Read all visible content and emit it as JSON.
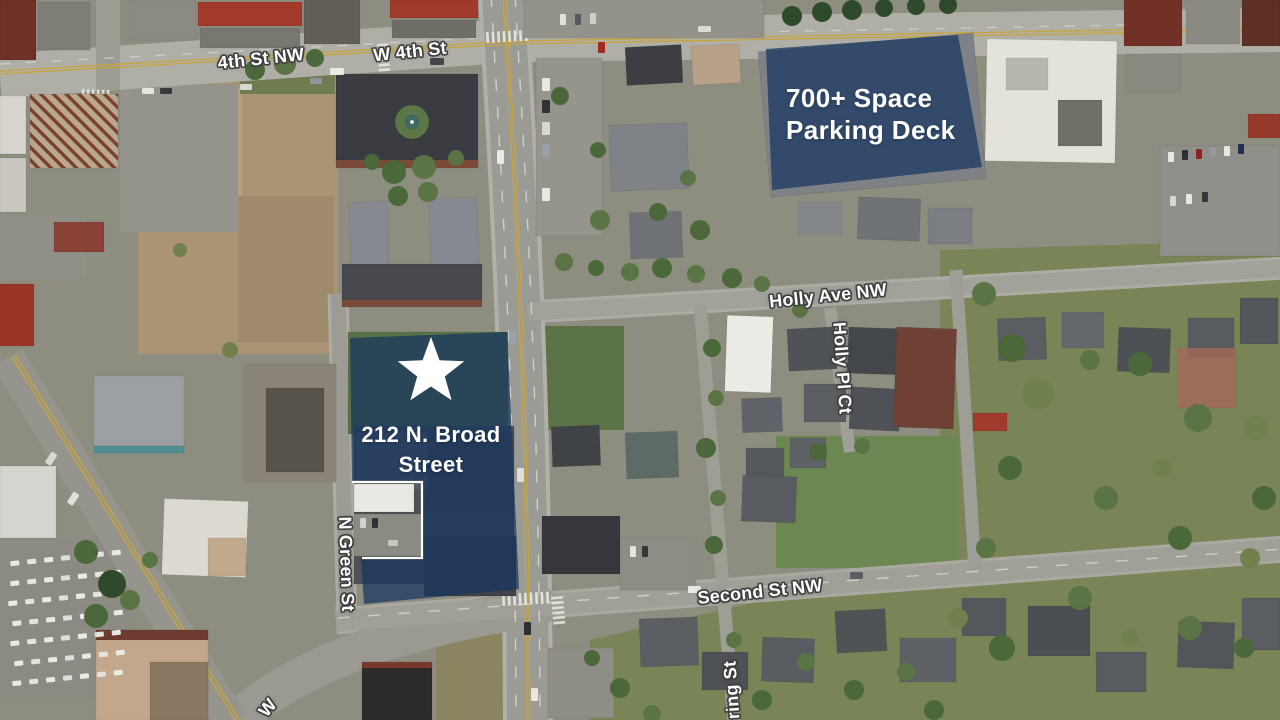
{
  "map": {
    "overlays": {
      "property": {
        "line1": "212 N. Broad",
        "line2": "Street"
      },
      "parking_deck": {
        "line1": "700+ Space",
        "line2": "Parking Deck"
      }
    },
    "street_labels": {
      "fourth_st_nw": "4th St NW",
      "w_fourth_st": "W 4th St",
      "holly_ave_nw": "Holly Ave NW",
      "holly_pl_ct": "Holly Pl Ct",
      "n_green_st": "N Green St",
      "second_st_nw": "Second St NW",
      "spring_st_partial": "ring St",
      "nw_partial": "W"
    },
    "colors": {
      "overlay_blue": "#16355f",
      "label_white": "#ffffff"
    }
  }
}
